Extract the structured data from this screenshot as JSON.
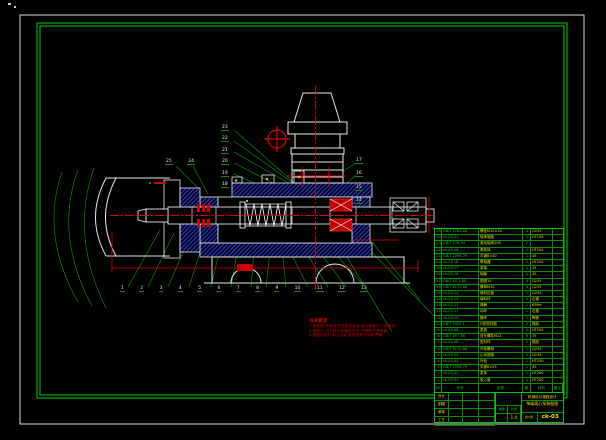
{
  "callouts": {
    "bottom": [
      "1",
      "2",
      "3",
      "4",
      "5",
      "6",
      "7",
      "8",
      "9",
      "10",
      "11",
      "12",
      "13"
    ],
    "mid_column": [
      "23",
      "22",
      "21",
      "20",
      "19",
      "18"
    ],
    "left_pair": [
      "25",
      "24"
    ],
    "right_column": [
      "17",
      "16",
      "15",
      "14"
    ]
  },
  "notes": {
    "title": "技术要求",
    "lines": [
      "1.装配前,所有零件用煤油清洗,滚动轴承用汽油清洗;",
      "2.装配后,用手转动泵轴应灵活,不得有卡滞现象;",
      "3.装配后进行水压试验,各密封处不得有渗漏."
    ]
  },
  "bom": {
    "headers": [
      "序号",
      "代号",
      "名称",
      "数量",
      "材料",
      "备注"
    ],
    "rows": [
      {
        "no": "25",
        "code": "GB/T 5783-86",
        "name": "螺栓M10×35",
        "qty": "4",
        "mat": "Q235",
        "rem": ""
      },
      {
        "no": "24",
        "code": "ck-03-21",
        "name": "轴承端盖",
        "qty": "1",
        "mat": "HT150",
        "rem": ""
      },
      {
        "no": "23",
        "code": "GB/T 276-94",
        "name": "滚动轴承208",
        "qty": "2",
        "mat": "",
        "rem": ""
      },
      {
        "no": "22",
        "code": "ck-03-19",
        "name": "悬架体",
        "qty": "1",
        "mat": "HT200",
        "rem": ""
      },
      {
        "no": "21",
        "code": "GB/T 1096-79",
        "name": "平键8×40",
        "qty": "1",
        "mat": "45",
        "rem": ""
      },
      {
        "no": "20",
        "code": "ck-03-18",
        "name": "联轴器",
        "qty": "1",
        "mat": "HT200",
        "rem": ""
      },
      {
        "no": "19",
        "code": "ck-03-17",
        "name": "泵轴",
        "qty": "1",
        "mat": "45",
        "rem": ""
      },
      {
        "no": "18",
        "code": "ck-03-16",
        "name": "轴套",
        "qty": "1",
        "mat": "45",
        "rem": ""
      },
      {
        "no": "17",
        "code": "GB/T 97.1-85",
        "name": "垫圈10",
        "qty": "4",
        "mat": "Q235",
        "rem": ""
      },
      {
        "no": "16",
        "code": "GB/T 6170-86",
        "name": "螺母M10",
        "qty": "4",
        "mat": "Q235",
        "rem": ""
      },
      {
        "no": "15",
        "code": "ck-03-14",
        "name": "填料压盖",
        "qty": "1",
        "mat": "Q235",
        "rem": ""
      },
      {
        "no": "14",
        "code": "ck-03-13",
        "name": "填料环",
        "qty": "1",
        "mat": "石棉",
        "rem": ""
      },
      {
        "no": "13",
        "code": "ck-03-12",
        "name": "弹簧",
        "qty": "1",
        "mat": "65Mn",
        "rem": ""
      },
      {
        "no": "12",
        "code": "ck-03-11",
        "name": "动环",
        "qty": "1",
        "mat": "石墨",
        "rem": ""
      },
      {
        "no": "11",
        "code": "ck-03-10",
        "name": "静环",
        "qty": "1",
        "mat": "陶瓷",
        "rem": ""
      },
      {
        "no": "10",
        "code": "GB/T 3452.1",
        "name": "O形密封圈",
        "qty": "2",
        "mat": "橡胶",
        "rem": ""
      },
      {
        "no": "9",
        "code": "ck-03-08",
        "name": "泵盖",
        "qty": "1",
        "mat": "HT200",
        "rem": ""
      },
      {
        "no": "8",
        "code": "GB/T 897-86",
        "name": "双头螺柱M12",
        "qty": "6",
        "mat": "35",
        "rem": ""
      },
      {
        "no": "7",
        "code": "ck-03-06",
        "name": "密封环",
        "qty": "2",
        "mat": "橡胶",
        "rem": ""
      },
      {
        "no": "6",
        "code": "GB/T 6170-86",
        "name": "叶轮螺母",
        "qty": "1",
        "mat": "Q235",
        "rem": ""
      },
      {
        "no": "5",
        "code": "ck-03-05",
        "name": "止动垫圈",
        "qty": "1",
        "mat": "Q235",
        "rem": ""
      },
      {
        "no": "4",
        "code": "ck-03-04",
        "name": "叶轮",
        "qty": "1",
        "mat": "HT150",
        "rem": ""
      },
      {
        "no": "3",
        "code": "GB/T 1096-79",
        "name": "平键6×25",
        "qty": "1",
        "mat": "45",
        "rem": ""
      },
      {
        "no": "2",
        "code": "ck-03-02",
        "name": "泵体",
        "qty": "1",
        "mat": "HT200",
        "rem": ""
      },
      {
        "no": "1",
        "code": "ck-03-01",
        "name": "吸入管",
        "qty": "1",
        "mat": "HT200",
        "rem": ""
      }
    ]
  },
  "title_block": {
    "school": "机械设计课程设计",
    "title": "单级离心泵装配图",
    "drawing_no": "ck-03",
    "weight_label": "重量",
    "scale_label": "比例",
    "scale": "1:4",
    "sheets": "共1张",
    "sig_labels": [
      "设计",
      "制图",
      "审核",
      "工艺"
    ]
  }
}
